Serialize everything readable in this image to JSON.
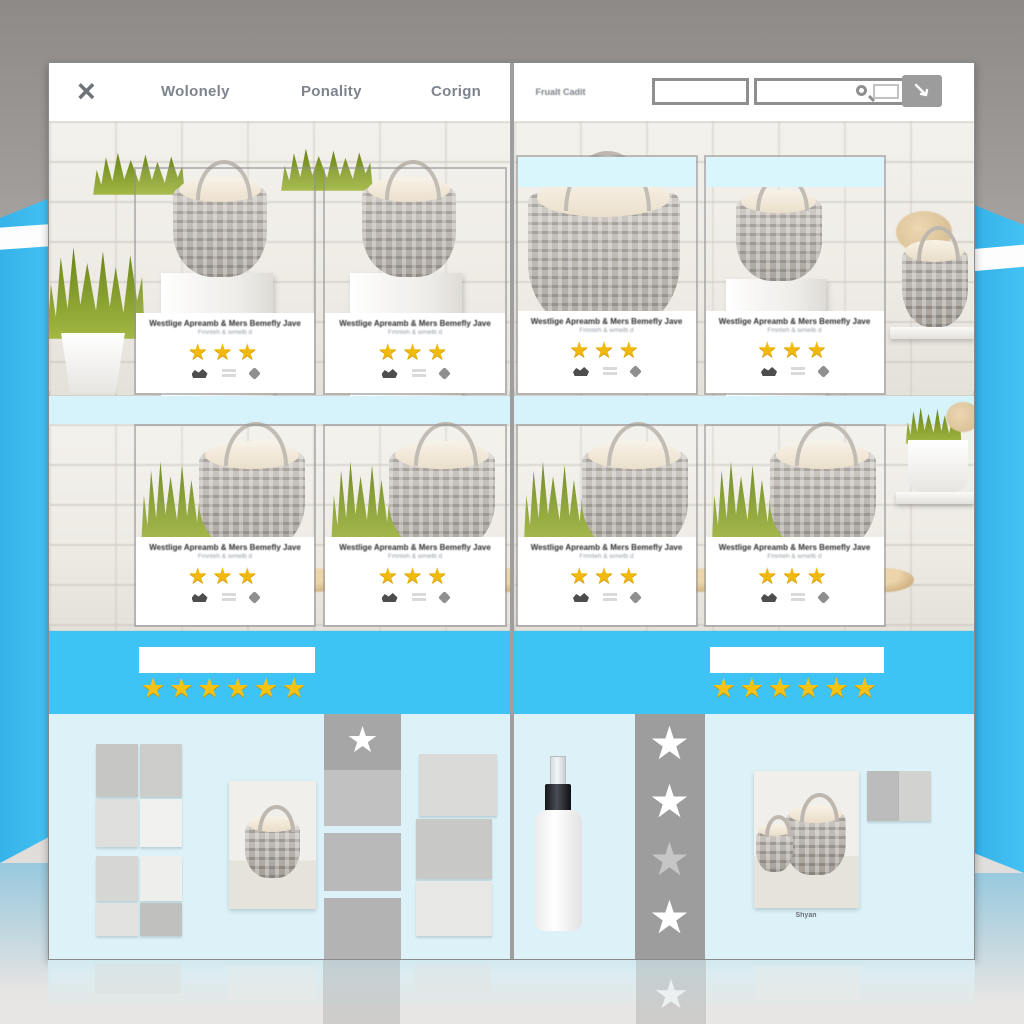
{
  "theme": {
    "accent_blue": "#3ec4f4",
    "wing_blue": "#3bbdf1",
    "pale_cyan": "#ddf2f8",
    "card_header_cyan": "#d9f6fd",
    "star_gold": "#f2b90d",
    "column_gray": "#9d9d9d"
  },
  "icons": {
    "close": "×",
    "search": "magnifier",
    "cursor_button": "arrow-cursor",
    "star": "★"
  },
  "left_page": {
    "close_glyph": "×",
    "nav": [
      {
        "label": "Wolonely"
      },
      {
        "label": "Ponality"
      },
      {
        "label": "Corign"
      }
    ],
    "banner": {
      "rating": 6,
      "stars_text": "★★★★★★",
      "input_value": ""
    },
    "bottom": {
      "swatch_grid_a": [
        "#c6c6c4",
        "#cccccb",
        "#dededc",
        "#f0f0ee"
      ],
      "swatch_grid_b": [
        "#d6d6d4",
        "#eeeeec",
        "#e2e2e0",
        "#c0c0be"
      ],
      "swatch_column": [
        "#dadad8",
        "#c8c8c6",
        "#e7e7e5"
      ],
      "column_blocks": [
        "#a6a6a6",
        "#c1c1c1",
        "#b9b9b9",
        "#b3b3b3"
      ],
      "column_star_glyph": "★",
      "column_star_color": "#ffffff"
    }
  },
  "right_page": {
    "brand": "Frualt Cadit",
    "search": {
      "field1_value": "",
      "field2_value": ""
    },
    "banner": {
      "rating": 6,
      "stars_text": "★★★★★★",
      "input_value": ""
    },
    "detail": {
      "caption": "Shyan",
      "star_glyph": "★",
      "star_colors": [
        "#ffffff",
        "#ffffff",
        "#c6c6c6",
        "#ffffff"
      ],
      "swatch_pair": [
        "#bcbcbc",
        "#d2d2d0"
      ]
    }
  },
  "products": [
    {
      "title": "Westlige Apreamb & Mers Bemefly Jave",
      "subtitle": "Fmnteh & wmelb d",
      "rating": 3,
      "stars_text": "★★★"
    },
    {
      "title": "Westlige Apreamb & Mers Bemefly Jave",
      "subtitle": "Fmnteh & wmelb d",
      "rating": 3,
      "stars_text": "★★★"
    },
    {
      "title": "Westlige Apreamb & Mers Bemefly Jave",
      "subtitle": "Fmnteh & wmelb d",
      "rating": 3,
      "stars_text": "★★★"
    },
    {
      "title": "Westlige Apreamb & Mers Bemefly Jave",
      "subtitle": "Fmnteh & wmelb d",
      "rating": 3,
      "stars_text": "★★★"
    },
    {
      "title": "Westlige Apreamb & Mers Bemefly Jave",
      "subtitle": "Fmnteh & wmelb d",
      "rating": 3,
      "stars_text": "★★★"
    },
    {
      "title": "Westlige Apreamb & Mers Bemefly Jave",
      "subtitle": "Fmnteh & wmelb d",
      "rating": 3,
      "stars_text": "★★★"
    },
    {
      "title": "Westlige Apreamb & Mers Bemefly Jave",
      "subtitle": "Fmnteh & wmelb d",
      "rating": 3,
      "stars_text": "★★★"
    },
    {
      "title": "Westlige Apreamb & Mers Bemefly Jave",
      "subtitle": "Fmnteh & wmelb d",
      "rating": 3,
      "stars_text": "★★★"
    }
  ]
}
